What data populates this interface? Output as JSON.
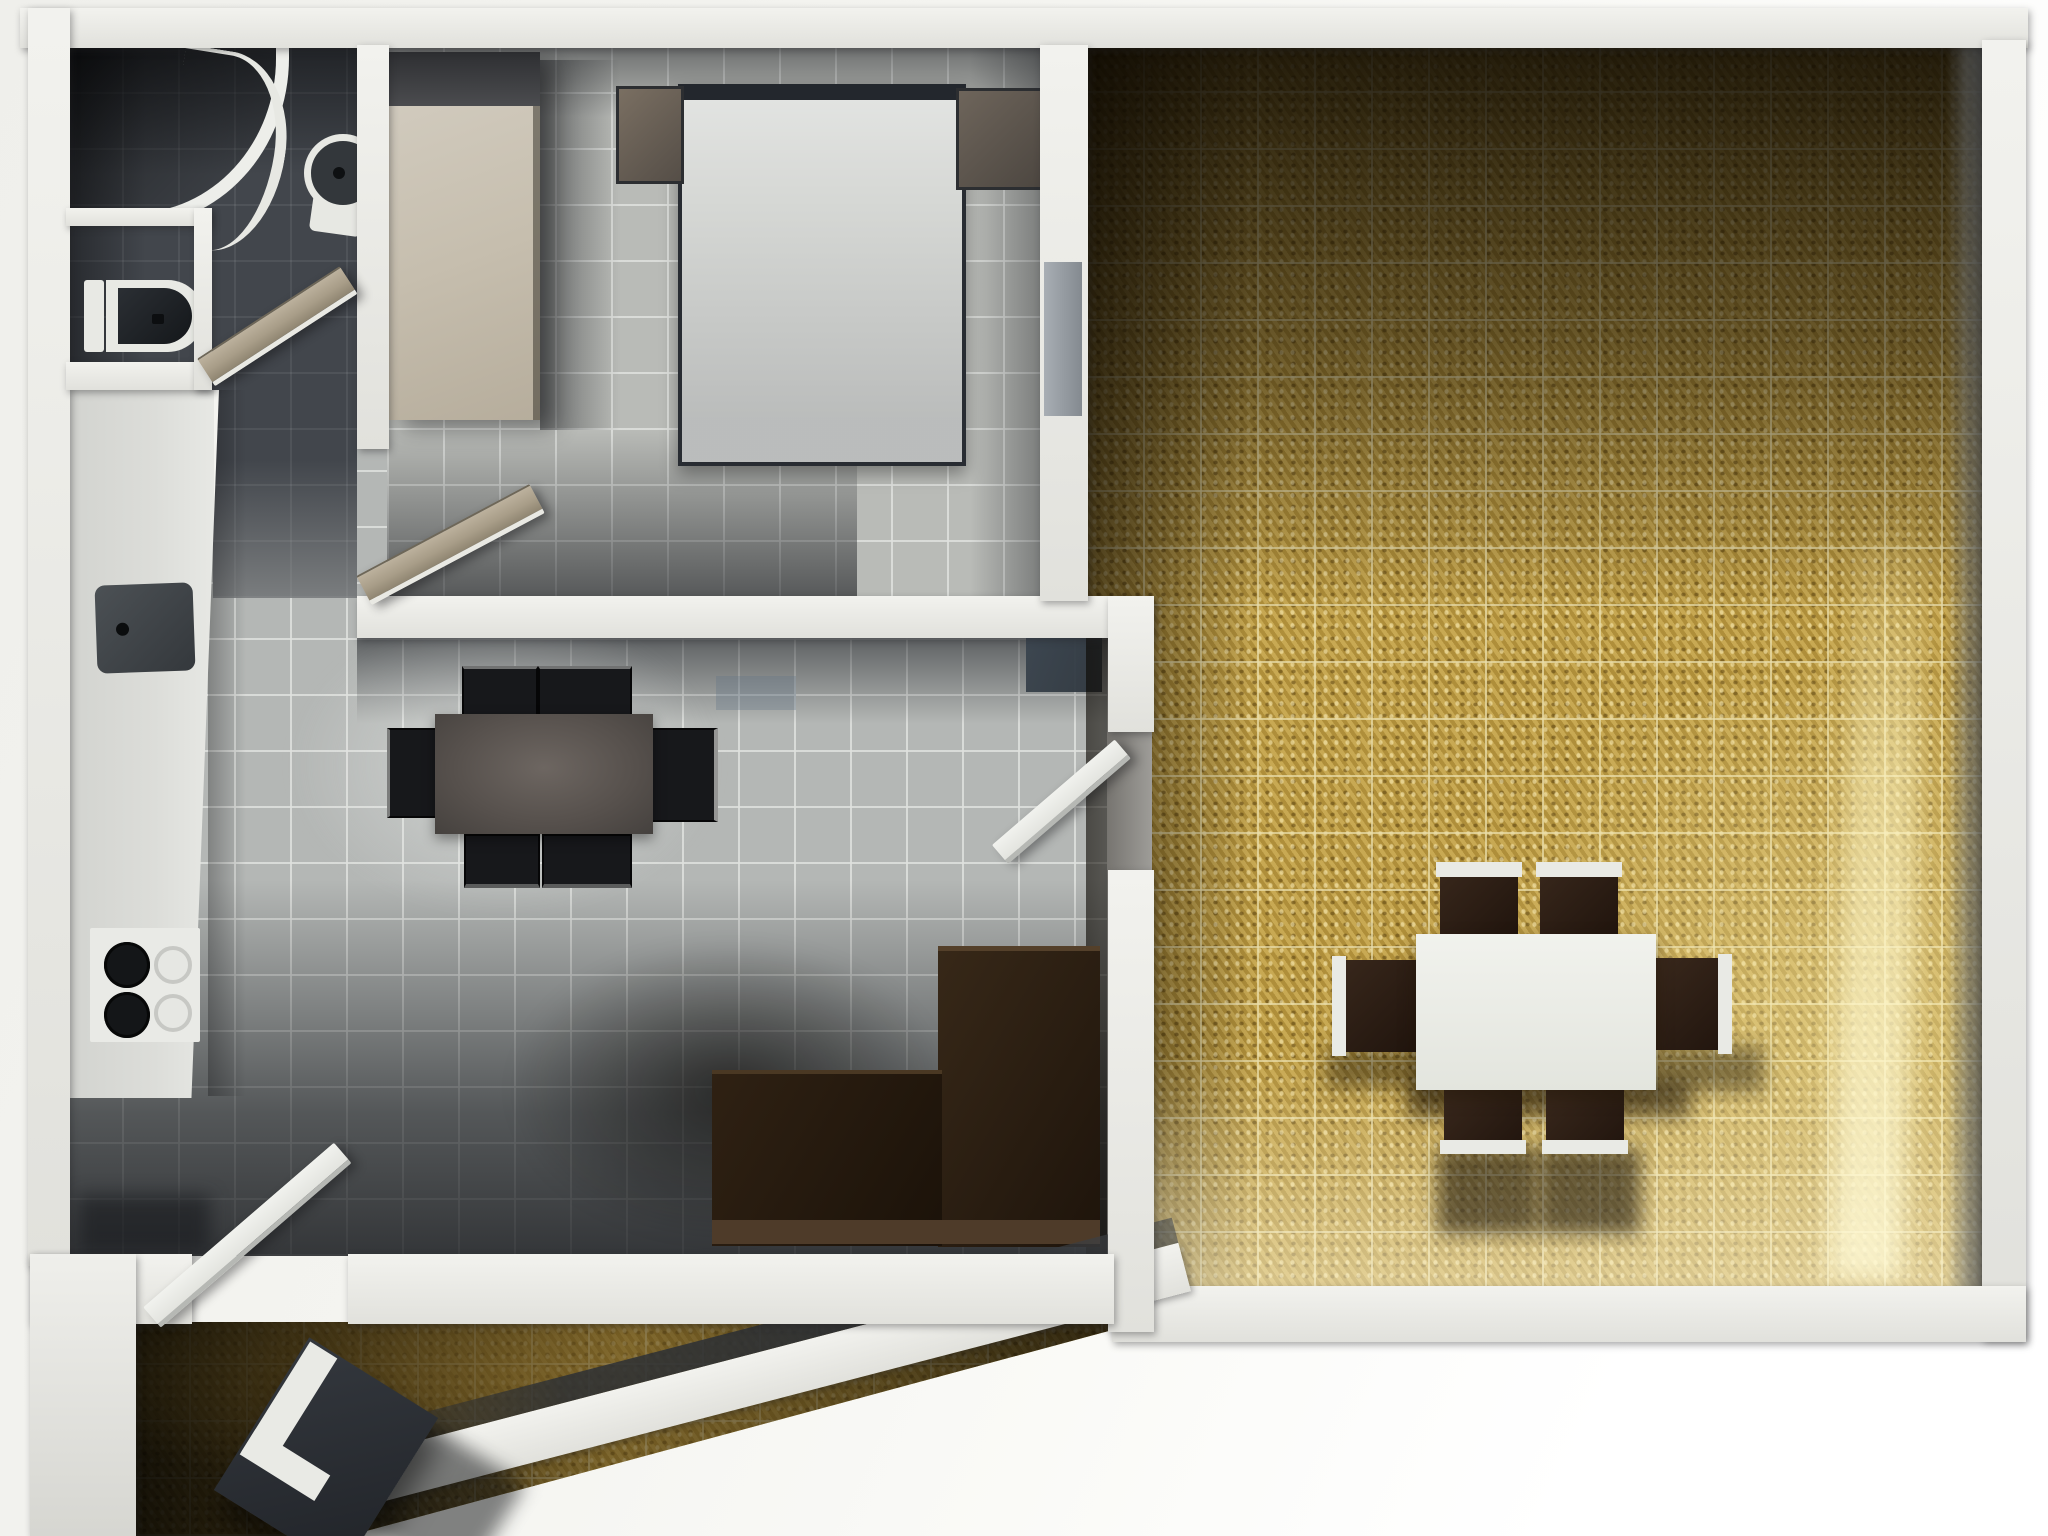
{
  "title": "Top-down 3D render of a one-bedroom apartment floor plan",
  "palette": {
    "wall": "#f2f2ee",
    "wall-shade": "#c9c9c4",
    "bath-floor": "#42464c",
    "tile": "#b4b7b5",
    "grout": "rgba(223,225,222,0.85)",
    "gold": "#bd9c43",
    "gold-grout": "rgba(233,221,170,0.75)",
    "dark-wood": "#241911",
    "chair-black": "#17181b",
    "table-dark": "#56504c",
    "white-furn": "#e9eae5",
    "chair-brown-dark": "#2d1f16",
    "door-tan": "#b3a995",
    "door-white": "#eef0ec",
    "door-gray": "#9aa0a6",
    "front-door": "#2e3237",
    "counter": "#d8d9d5",
    "sink-dark": "#44484c",
    "nightstand": "#6e6458",
    "wardrobe": "#c9c2b4",
    "bed": "#d4d6d3",
    "bed-frame": "#23272d"
  },
  "rooms": {
    "bathroom": {
      "label": "Bathroom",
      "items": [
        "corner shower",
        "washbasin",
        "toilet",
        "open door"
      ]
    },
    "bedroom": {
      "label": "Bedroom",
      "items": [
        "double bed",
        "left nightstand",
        "right nightstand",
        "wardrobe",
        "open door"
      ]
    },
    "kitchen": {
      "label": "Kitchen and dining area",
      "items": [
        "kitchen counter",
        "sink",
        "stove with four burners",
        "dark dining table",
        "four black chairs",
        "corner sofa",
        "door to living room",
        "door to entry"
      ]
    },
    "living_room": {
      "label": "Living room",
      "items": [
        "white dining table",
        "six brown chairs",
        "gold patterned tile floor",
        "closed gray door"
      ]
    },
    "entry": {
      "label": "Entry hall",
      "items": [
        "open front door",
        "gold tiled floor",
        "diagonal outer wall"
      ]
    }
  }
}
